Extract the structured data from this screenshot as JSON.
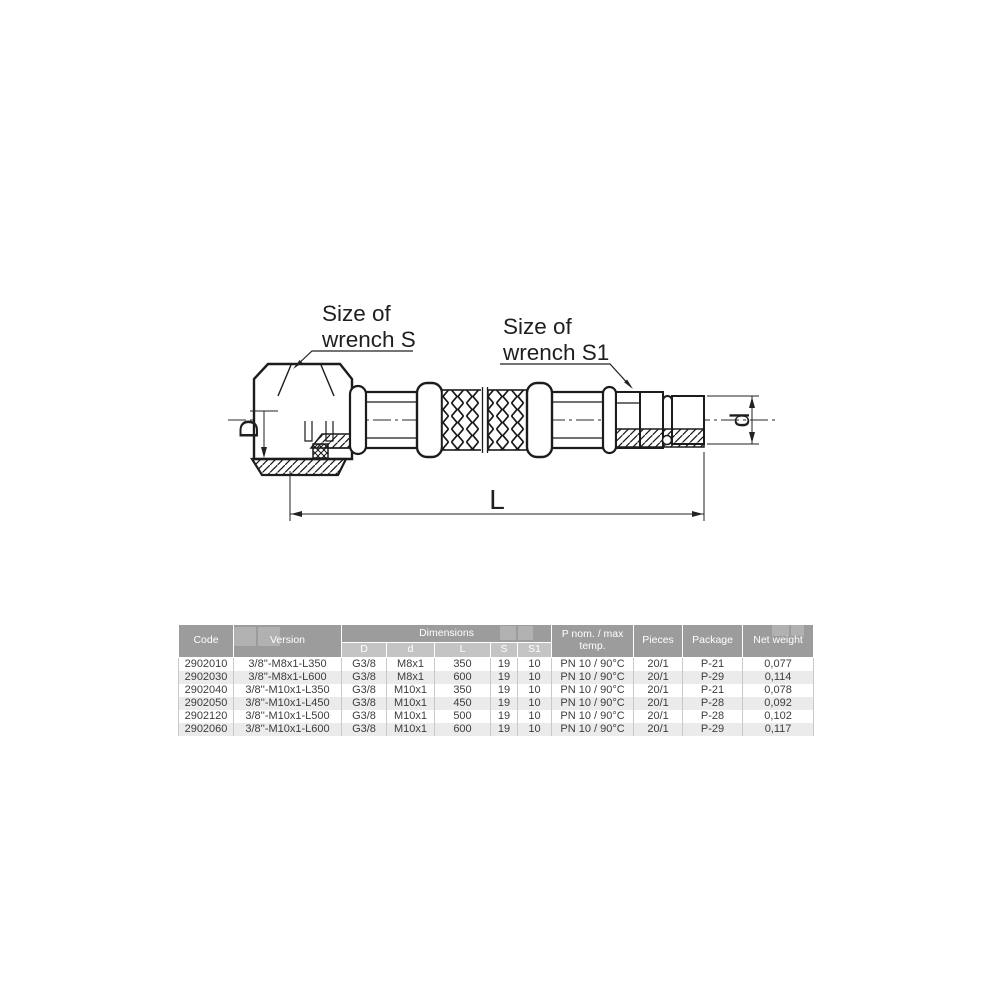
{
  "diagram": {
    "wrench_s_line1": "Size of",
    "wrench_s_line2": "wrench S",
    "wrench_s1_line1": "Size of",
    "wrench_s1_line2": "wrench S1",
    "dim_D": "D",
    "dim_d": "d",
    "dim_L": "L"
  },
  "table": {
    "headers": {
      "code": "Code",
      "version": "Version",
      "dimensions": "Dimensions",
      "dim_cols": [
        "D",
        "d",
        "L",
        "S",
        "S1"
      ],
      "p_nom": "P nom. / max temp.",
      "pieces": "Pieces",
      "package": "Package",
      "net_weight": "Net weight"
    },
    "rows": [
      [
        "2902010",
        "3/8''-M8x1-L350",
        "G3/8",
        "M8x1",
        "350",
        "19",
        "10",
        "PN 10 / 90°C",
        "20/1",
        "P-21",
        "0,077"
      ],
      [
        "2902030",
        "3/8''-M8x1-L600",
        "G3/8",
        "M8x1",
        "600",
        "19",
        "10",
        "PN 10 / 90°C",
        "20/1",
        "P-29",
        "0,114"
      ],
      [
        "2902040",
        "3/8''-M10x1-L350",
        "G3/8",
        "M10x1",
        "350",
        "19",
        "10",
        "PN 10 / 90°C",
        "20/1",
        "P-21",
        "0,078"
      ],
      [
        "2902050",
        "3/8''-M10x1-L450",
        "G3/8",
        "M10x1",
        "450",
        "19",
        "10",
        "PN 10 / 90°C",
        "20/1",
        "P-28",
        "0,092"
      ],
      [
        "2902120",
        "3/8''-M10x1-L500",
        "G3/8",
        "M10x1",
        "500",
        "19",
        "10",
        "PN 10 / 90°C",
        "20/1",
        "P-28",
        "0,102"
      ],
      [
        "2902060",
        "3/8''-M10x1-L600",
        "G3/8",
        "M10x1",
        "600",
        "19",
        "10",
        "PN 10 / 90°C",
        "20/1",
        "P-29",
        "0,117"
      ]
    ]
  },
  "colors": {
    "header_bg": "#9c9c9c",
    "subheader_bg": "#c4c4c4",
    "row_alt_bg": "#ebebeb",
    "line": "#1c1c1c",
    "table_text": "#3d3d3d"
  }
}
